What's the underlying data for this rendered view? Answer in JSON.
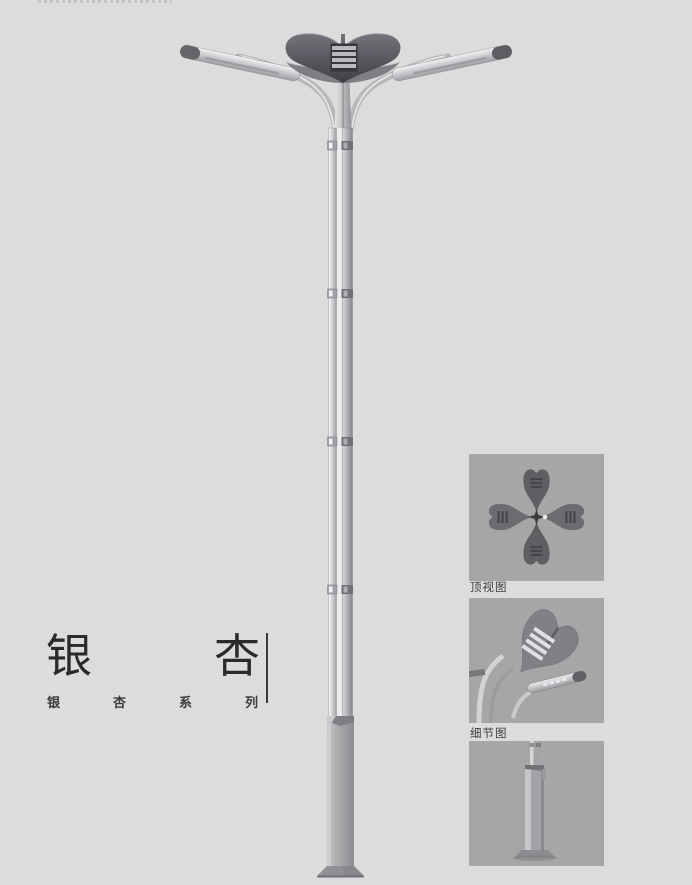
{
  "page": {
    "width": 692,
    "height": 885,
    "background": "#dcdcdd"
  },
  "title_block": {
    "title": "银杏",
    "subtitle": "银杏系列"
  },
  "detail_panels": [
    {
      "id": "top-view",
      "label": "顶视图"
    },
    {
      "id": "detail-view",
      "label": "细节图"
    },
    {
      "id": "base-view",
      "label": ""
    }
  ],
  "colors": {
    "page_bg": "#dcdcdd",
    "panel_bg": "#a6a6a6",
    "title_text": "#2b2a28",
    "crown_dark": "#47474d",
    "metal_silver": "#b7b8ba"
  }
}
